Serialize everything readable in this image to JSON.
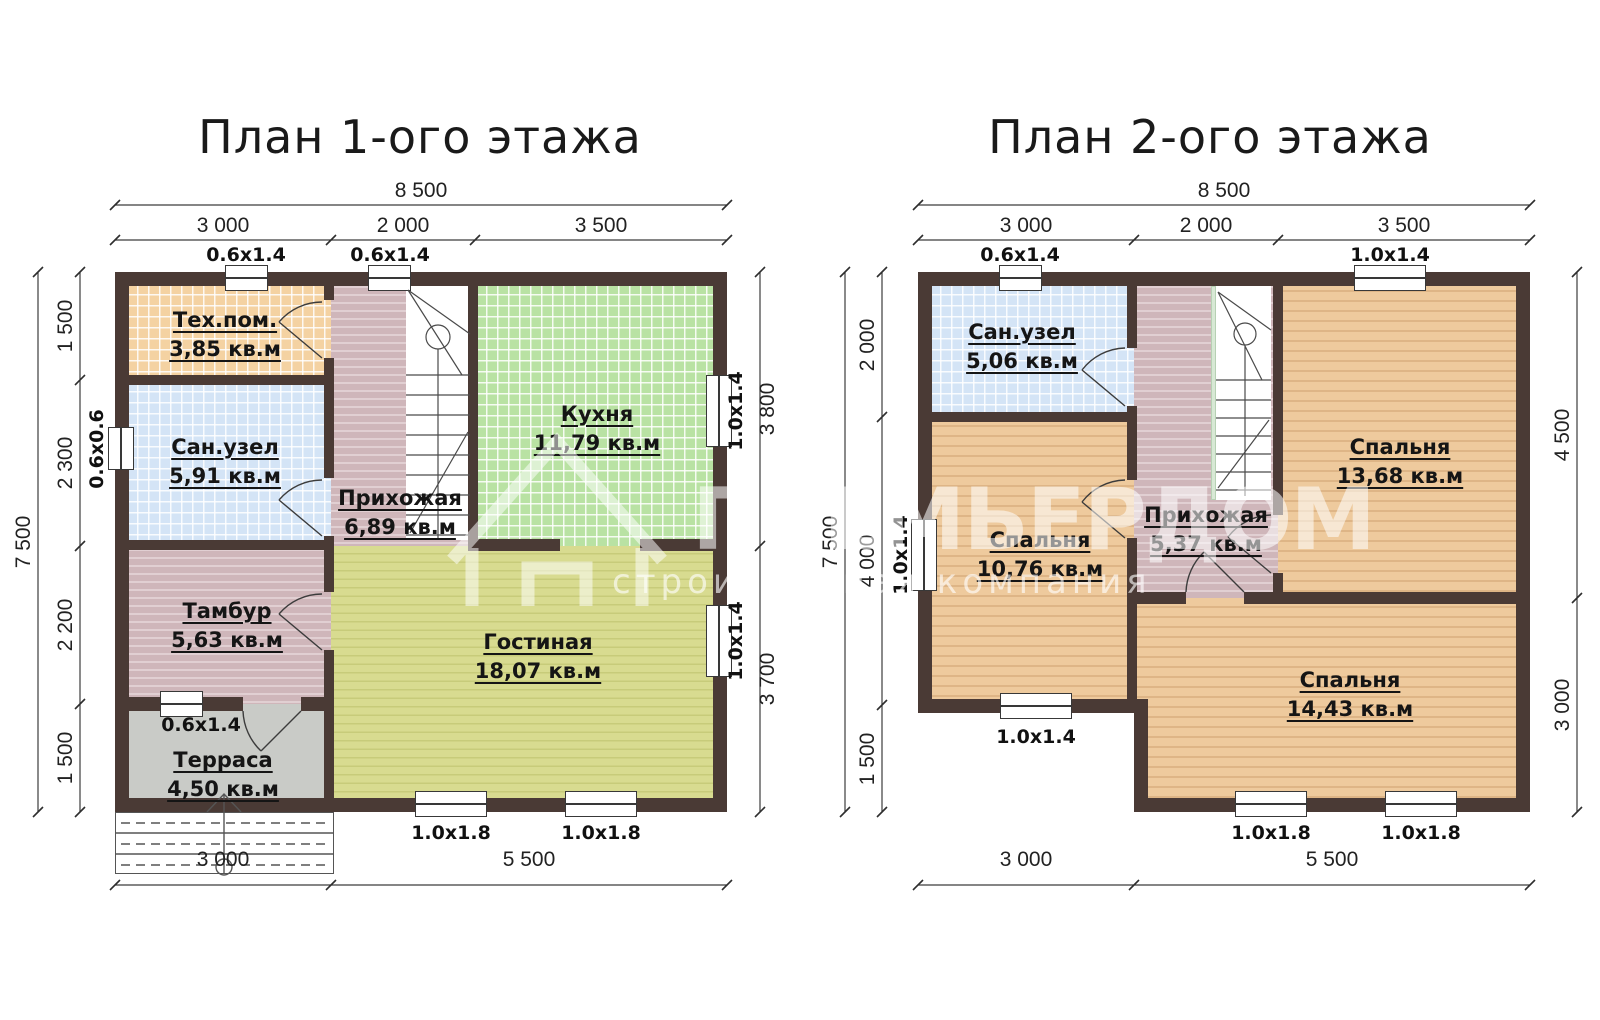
{
  "plan1": {
    "title": "План 1-ого этажа",
    "dim_total_width": "8 500",
    "dim_top": [
      "3 000",
      "2 000",
      "3 500"
    ],
    "dim_total_height": "7 500",
    "dim_left": [
      "1 500",
      "2 300",
      "2 200",
      "1 500"
    ],
    "dim_right": [
      "3 800",
      "3 700"
    ],
    "dim_bottom": [
      "3 000",
      "5 500"
    ],
    "win_top": [
      "0.6x1.4",
      "0.6x1.4"
    ],
    "win_left": "0.6x0.6",
    "win_right": [
      "1.0x1.4",
      "1.0x1.4"
    ],
    "win_bottom": [
      "1.0x1.8",
      "1.0x1.8"
    ],
    "win_terrace": "0.6x1.4",
    "rooms": [
      {
        "name": "Тех.пом.",
        "area": "3,85 кв.м"
      },
      {
        "name": "Сан.узел",
        "area": "5,91 кв.м"
      },
      {
        "name": "Прихожая",
        "area": "6,89 кв.м"
      },
      {
        "name": "Кухня",
        "area": "11,79 кв.м"
      },
      {
        "name": "Тамбур",
        "area": "5,63 кв.м"
      },
      {
        "name": "Гостиная",
        "area": "18,07 кв.м"
      },
      {
        "name": "Терраса",
        "area": "4,50 кв.м"
      }
    ]
  },
  "plan2": {
    "title": "План 2-ого этажа",
    "dim_total_width": "8 500",
    "dim_top": [
      "3 000",
      "2 000",
      "3 500"
    ],
    "dim_total_height": "7 500",
    "dim_left": [
      "2 000",
      "4 000",
      "1 500"
    ],
    "dim_right": [
      "4 500",
      "3 000"
    ],
    "dim_bottom": [
      "3 000",
      "5 500"
    ],
    "win_top": [
      "0.6x1.4",
      "1.0x1.4"
    ],
    "win_left": "1.0x1.4",
    "win_mid": "1.0x1.4",
    "win_bottom": [
      "1.0x1.8",
      "1.0x1.8"
    ],
    "rooms": [
      {
        "name": "Сан.узел",
        "area": "5,06 кв.м"
      },
      {
        "name": "Спальня",
        "area": "10,76 кв.м"
      },
      {
        "name": "Прихожая",
        "area": "5,37 кв.м"
      },
      {
        "name": "Спальня",
        "area": "13,68 кв.м"
      },
      {
        "name": "Спальня",
        "area": "14,43 кв.м"
      }
    ]
  },
  "watermark": {
    "brand": "ПРЕМЬЕРДОМ",
    "tagline": "строительная компания"
  },
  "colors": {
    "wall": "#4a3a35",
    "tile_orange": "#f4d2a2",
    "tile_blue": "#d4e4f6",
    "tile_green": "#b9e2a3",
    "plank_mauve": "#cfb6ba",
    "plank_yellow": "#d8db90",
    "plank_orange": "#eeca9d",
    "plank_gray": "#c9cbc7"
  }
}
